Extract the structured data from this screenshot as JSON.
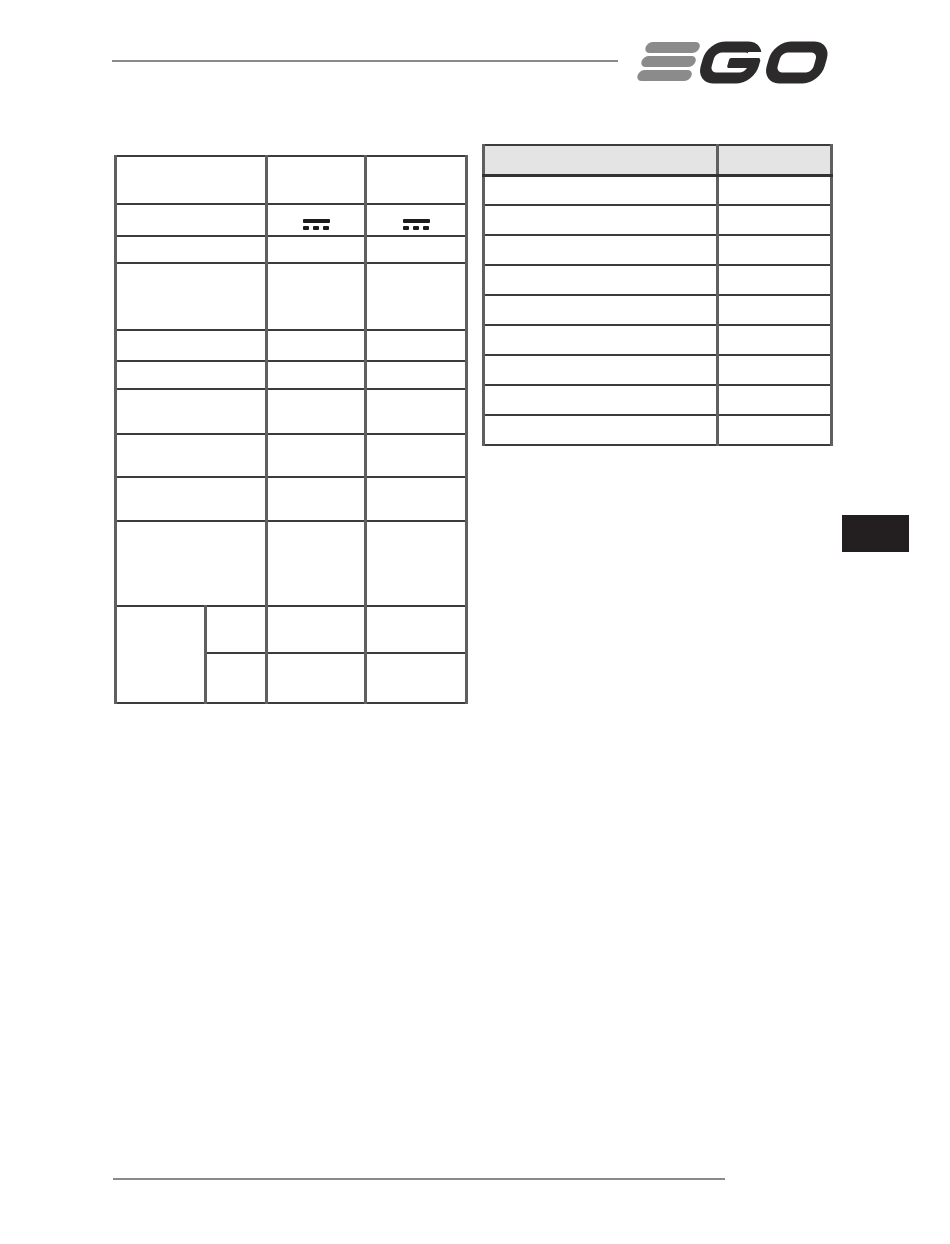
{
  "page": {
    "kind": "scanned-manual-page",
    "background": "#ffffff"
  },
  "header": {
    "rule_color": "#8a8a8a",
    "logo": {
      "brand": "EGO",
      "bar_color": "#8b8b8b",
      "letter_color": "#2d2a2b"
    }
  },
  "spec_table": {
    "description": "specifications table, all cells empty except two DC-voltage symbols",
    "border_color": "#3c3c3c",
    "col_widths": [
      90,
      61,
      99,
      101
    ],
    "dc_symbol": {
      "icon": "dc-voltage-icon",
      "unicode": "⎓",
      "color": "#1c1c1c"
    },
    "rows": [
      {
        "h": 48,
        "cells": [
          {
            "span": 2,
            "text": ""
          },
          {
            "text": ""
          },
          {
            "text": ""
          }
        ]
      },
      {
        "h": 32,
        "cells": [
          {
            "span": 2,
            "text": ""
          },
          {
            "icon": "dc-voltage-icon"
          },
          {
            "icon": "dc-voltage-icon"
          }
        ]
      },
      {
        "h": 27,
        "cells": [
          {
            "span": 2,
            "text": ""
          },
          {
            "text": ""
          },
          {
            "text": ""
          }
        ]
      },
      {
        "h": 67,
        "cells": [
          {
            "span": 2,
            "text": ""
          },
          {
            "text": ""
          },
          {
            "text": ""
          }
        ]
      },
      {
        "h": 31,
        "cells": [
          {
            "span": 2,
            "text": ""
          },
          {
            "text": ""
          },
          {
            "text": ""
          }
        ]
      },
      {
        "h": 28,
        "cells": [
          {
            "span": 2,
            "text": ""
          },
          {
            "text": ""
          },
          {
            "text": ""
          }
        ]
      },
      {
        "h": 45,
        "cells": [
          {
            "span": 2,
            "text": ""
          },
          {
            "text": ""
          },
          {
            "text": ""
          }
        ]
      },
      {
        "h": 43,
        "cells": [
          {
            "span": 2,
            "text": ""
          },
          {
            "text": ""
          },
          {
            "text": ""
          }
        ]
      },
      {
        "h": 44,
        "cells": [
          {
            "span": 2,
            "text": ""
          },
          {
            "text": ""
          },
          {
            "text": ""
          }
        ]
      },
      {
        "h": 85,
        "cells": [
          {
            "span": 2,
            "text": ""
          },
          {
            "text": ""
          },
          {
            "text": ""
          }
        ]
      },
      {
        "h": 47,
        "cells": [
          {
            "rowspan": 2,
            "text": ""
          },
          {
            "text": ""
          },
          {
            "text": ""
          },
          {
            "text": ""
          }
        ]
      },
      {
        "h": 50,
        "cells": [
          {
            "text": ""
          },
          {
            "text": ""
          },
          {
            "text": ""
          }
        ]
      }
    ]
  },
  "parts_table": {
    "description": "two-column table with shaded header row, all cells empty",
    "header_fill": "#e4e4e4",
    "col_widths": [
      234,
      114
    ],
    "header_h": 30,
    "row_h": 30,
    "body_rows": 9,
    "header_cells": [
      "",
      ""
    ]
  },
  "side_tab": {
    "name": "section-index-tab",
    "color": "#231f20"
  },
  "footer": {
    "rule_color": "#8a8a8a"
  }
}
